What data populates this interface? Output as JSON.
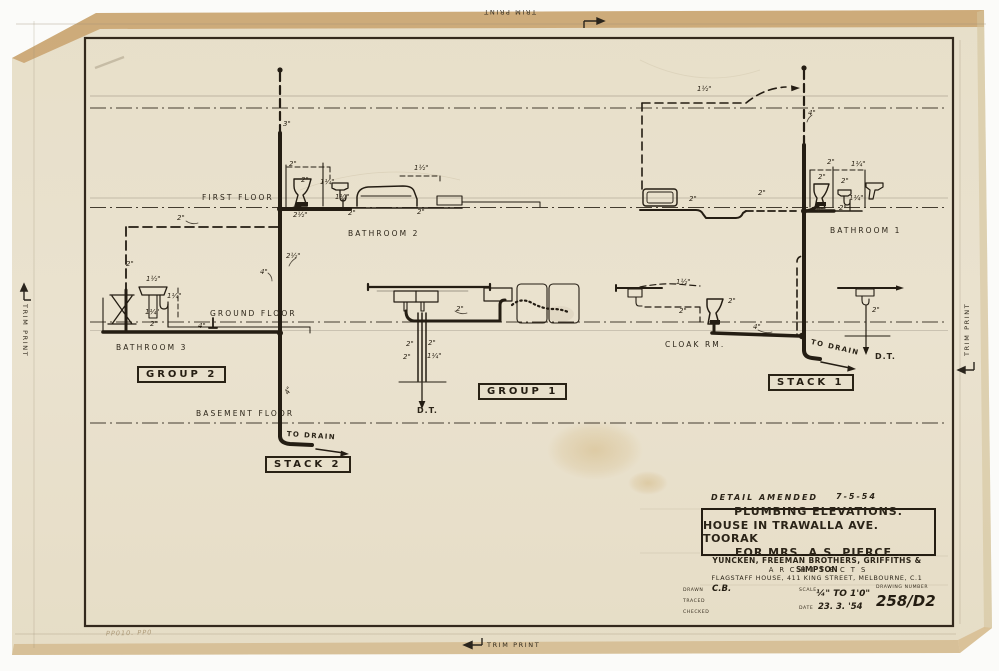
{
  "trim": {
    "label": "TRIM PRINT"
  },
  "floor_labels": {
    "first": "FIRST FLOOR",
    "ground": "GROUND FLOOR",
    "basement": "BASEMENT FLOOR"
  },
  "room_labels": {
    "bathroom2": "BATHROOM 2",
    "bathroom3": "BATHROOM 3",
    "bathroom1": "BATHROOM 1",
    "cloak_rm": "CLOAK RM."
  },
  "group_labels": {
    "group2": "GROUP 2",
    "stack2": "STACK 2",
    "group1": "GROUP 1",
    "stack1": "STACK 1"
  },
  "flow_labels": {
    "to_drain_stack2": "TO DRAIN",
    "to_drain_stack1": "TO DRAIN",
    "dt_group1": "D.T.",
    "dt_right": "D.T."
  },
  "amendment": {
    "text": "DETAIL AMENDED",
    "date": "7-5-54"
  },
  "title_block": {
    "title_line1": "PLUMBING ELEVATIONS.",
    "title_line2": "HOUSE IN TRAWALLA AVE. TOORAK",
    "title_line3": "FOR MRS. A.S. PIERCE .",
    "firm": "YUNCKEN, FREEMAN BROTHERS, GRIFFITHS & SIMPSON",
    "profession": "ARCHITECTS",
    "address": "FLAGSTAFF HOUSE, 411 KING STREET, MELBOURNE, C.1",
    "drawn_label": "DRAWN",
    "drawn_value": "C.B.",
    "traced_label": "TRACED",
    "checked_label": "CHECKED",
    "scale_label": "SCALE",
    "scale_value": "¼\" TO 1'0\"",
    "date_label": "DATE",
    "date_value": "23. 3. '54",
    "number_label": "DRAWING NUMBER",
    "number_value": "258/D2"
  },
  "pencil_note": "PP010. PP0",
  "annotations": [
    {
      "text": "3\"",
      "x": 283,
      "y": 120
    },
    {
      "text": "2\"",
      "x": 177,
      "y": 214
    },
    {
      "text": "2\"",
      "x": 126,
      "y": 260
    },
    {
      "text": "2\"",
      "x": 289,
      "y": 160
    },
    {
      "text": "2\"",
      "x": 301,
      "y": 176
    },
    {
      "text": "1¼\"",
      "x": 320,
      "y": 178
    },
    {
      "text": "1¼\"",
      "x": 335,
      "y": 193
    },
    {
      "text": "1½\"",
      "x": 414,
      "y": 164
    },
    {
      "text": "2½\"",
      "x": 293,
      "y": 211
    },
    {
      "text": "2\"",
      "x": 348,
      "y": 209
    },
    {
      "text": "2\"",
      "x": 417,
      "y": 208
    },
    {
      "text": "2½\"",
      "x": 286,
      "y": 252
    },
    {
      "text": "4\"",
      "x": 260,
      "y": 268
    },
    {
      "text": "1½\"",
      "x": 146,
      "y": 275
    },
    {
      "text": "1¼\"",
      "x": 167,
      "y": 292
    },
    {
      "text": "1¼\"",
      "x": 145,
      "y": 308
    },
    {
      "text": "2\"",
      "x": 150,
      "y": 320
    },
    {
      "text": "4\"",
      "x": 198,
      "y": 322
    },
    {
      "text": "4\"",
      "x": 283,
      "y": 392,
      "r": -60
    },
    {
      "text": "2\"",
      "x": 456,
      "y": 305
    },
    {
      "text": "2\"",
      "x": 406,
      "y": 340
    },
    {
      "text": "2\"",
      "x": 428,
      "y": 339
    },
    {
      "text": "2\"",
      "x": 403,
      "y": 353
    },
    {
      "text": "1¼\"",
      "x": 427,
      "y": 352
    },
    {
      "text": "1½\"",
      "x": 697,
      "y": 85
    },
    {
      "text": "4\"",
      "x": 808,
      "y": 109
    },
    {
      "text": "2\"",
      "x": 689,
      "y": 195
    },
    {
      "text": "2\"",
      "x": 758,
      "y": 189
    },
    {
      "text": "1½\"",
      "x": 676,
      "y": 278
    },
    {
      "text": "2\"",
      "x": 679,
      "y": 307
    },
    {
      "text": "2\"",
      "x": 728,
      "y": 297
    },
    {
      "text": "4\"",
      "x": 753,
      "y": 323
    },
    {
      "text": "2\"",
      "x": 827,
      "y": 158
    },
    {
      "text": "1¼\"",
      "x": 851,
      "y": 160
    },
    {
      "text": "2\"",
      "x": 818,
      "y": 173
    },
    {
      "text": "2\"",
      "x": 841,
      "y": 177
    },
    {
      "text": "1¼\"",
      "x": 849,
      "y": 194
    },
    {
      "text": "2\"",
      "x": 839,
      "y": 204
    },
    {
      "text": "4\"",
      "x": 816,
      "y": 206
    },
    {
      "text": "2\"",
      "x": 872,
      "y": 306
    }
  ]
}
